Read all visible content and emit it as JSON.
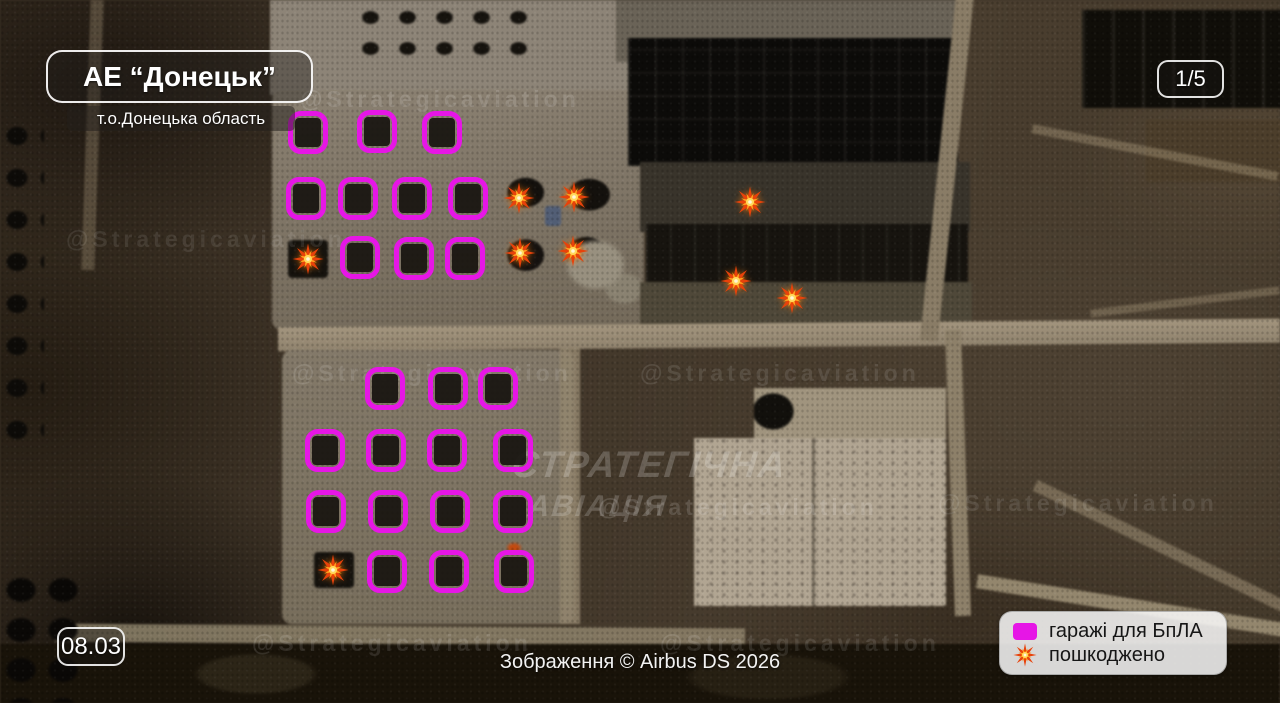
{
  "header": {
    "title": "АЕ “Донецьк”",
    "subtitle": "т.о.Донецька область",
    "page_indicator": "1/5"
  },
  "footer": {
    "date": "08.03",
    "attribution": "Зображення © Airbus DS 2026"
  },
  "legend": {
    "garages_label": "гаражі для БпЛА",
    "damaged_label": "пошкоджено"
  },
  "watermark": {
    "handle": "@Strategicaviation",
    "center_line1": "СТРАТЕГІЧНА",
    "center_line2": "АВІАЦІЯ"
  },
  "colors": {
    "garage_marker": "#e616e6",
    "damage_outer": "#e8420a",
    "damage_mid": "#ff9d1c",
    "damage_core": "#ffd95e"
  },
  "annotations": {
    "garages": [
      [
        308,
        132
      ],
      [
        377,
        131
      ],
      [
        442,
        132
      ],
      [
        306,
        198
      ],
      [
        358,
        198
      ],
      [
        412,
        198
      ],
      [
        468,
        198
      ],
      [
        360,
        257
      ],
      [
        414,
        258
      ],
      [
        465,
        258
      ],
      [
        385,
        388
      ],
      [
        448,
        388
      ],
      [
        498,
        388
      ],
      [
        325,
        450
      ],
      [
        386,
        450
      ],
      [
        447,
        450
      ],
      [
        513,
        450
      ],
      [
        326,
        511
      ],
      [
        388,
        511
      ],
      [
        450,
        511
      ],
      [
        513,
        511
      ],
      [
        387,
        571
      ],
      [
        449,
        571
      ],
      [
        514,
        571
      ]
    ],
    "damage": [
      [
        308,
        259
      ],
      [
        519,
        198
      ],
      [
        574,
        197
      ],
      [
        520,
        253
      ],
      [
        573,
        251
      ],
      [
        750,
        202
      ],
      [
        736,
        281
      ],
      [
        792,
        298
      ],
      [
        333,
        570
      ]
    ]
  }
}
